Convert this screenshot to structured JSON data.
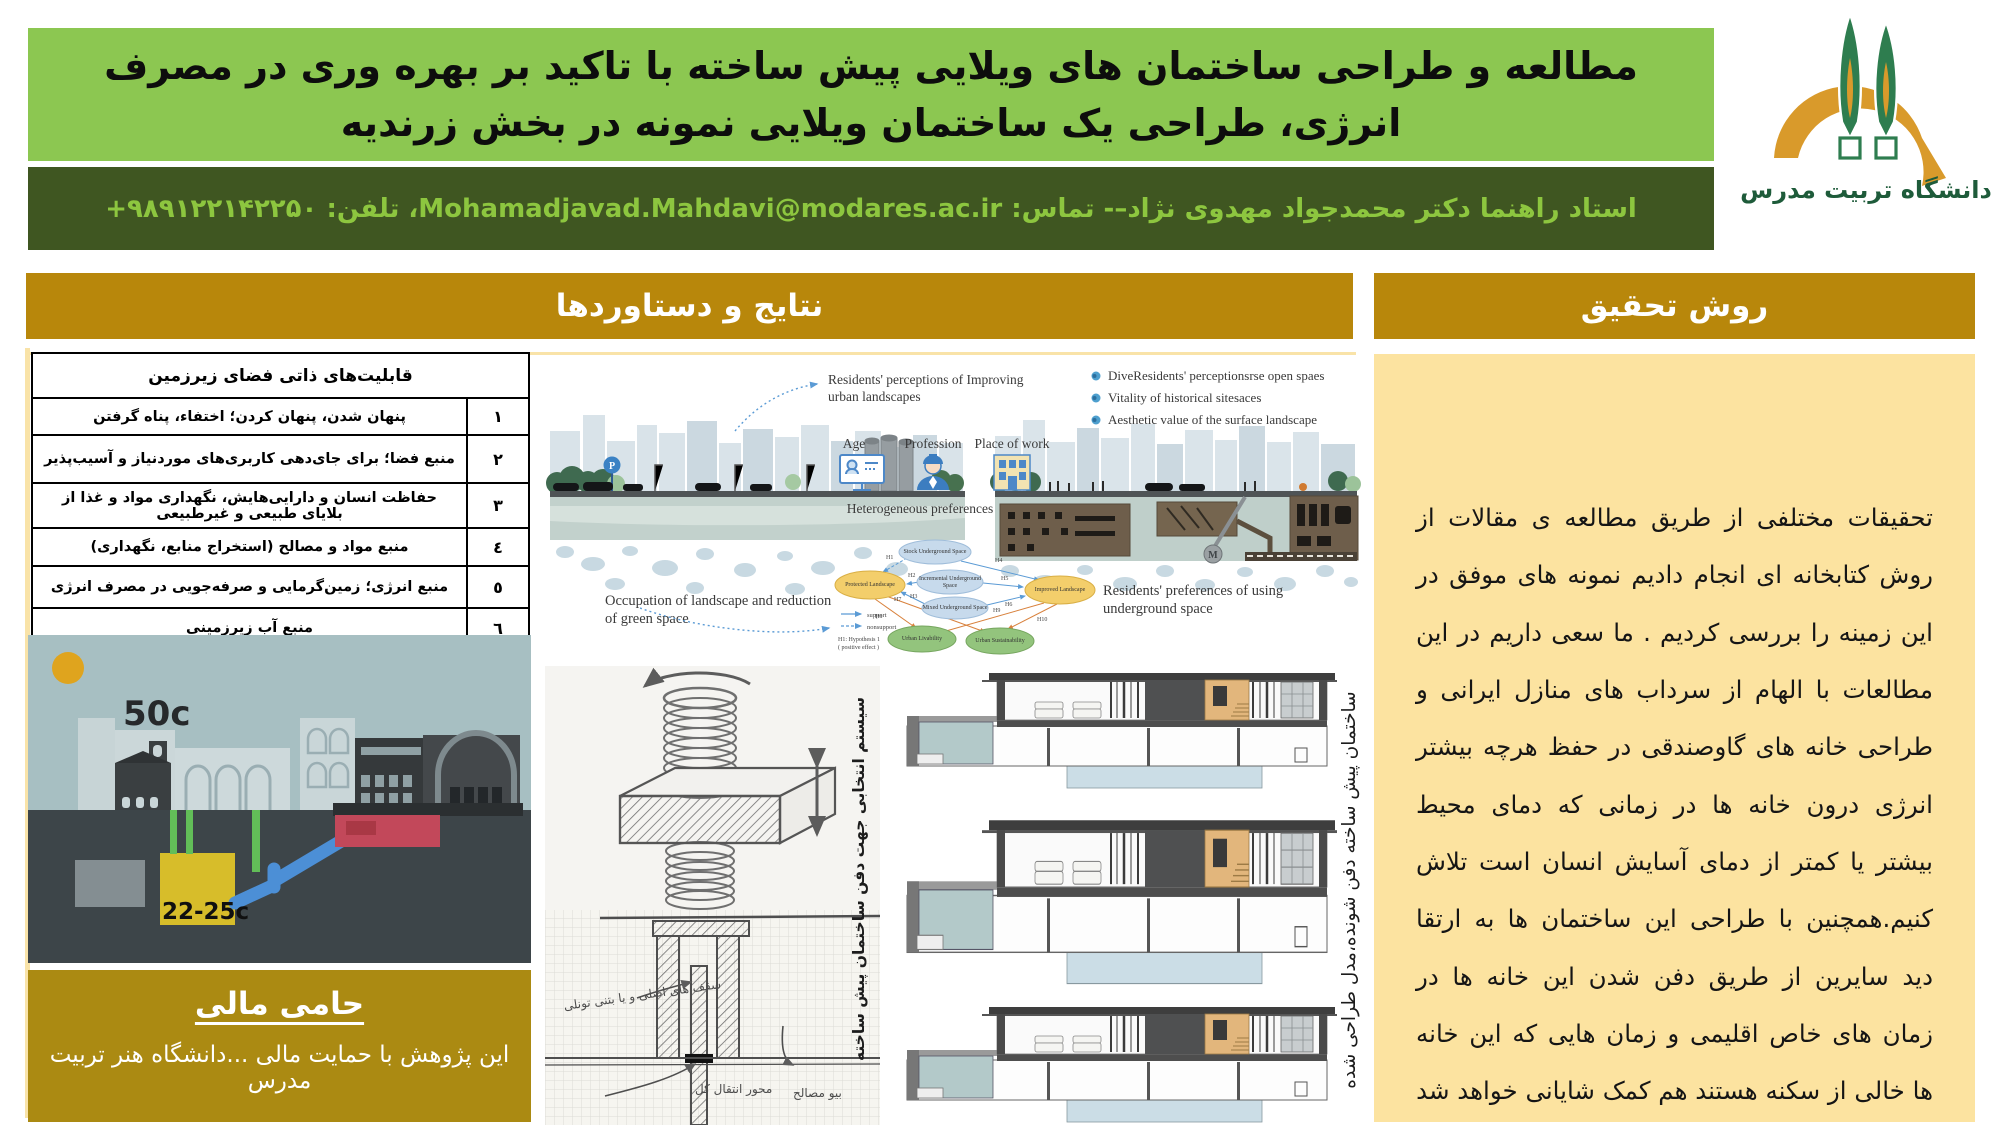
{
  "header": {
    "title": "مطالعه و طراحی ساختمان های ویلایی پیش ساخته با تاکید بر بهره وری در مصرف انرژی، طراحی یک ساختمان ویلایی نمونه در بخش زرندیه",
    "supervisor": "استاد راهنما دکتر محمدجواد مهدوی نژاد–- تماس: Mohamadjavad.Mahdavi@modares.ac.ir، تلفن: ۹۸۹۱۲۲۱۴۲۲۵۰+",
    "logo_caption": "دانشگاه تربیت مدرس"
  },
  "results": {
    "title": "نتایج و دستاوردها",
    "table": {
      "header": "قابلیت‌های ذاتی فضای زیرزمین",
      "rows": [
        {
          "num": "١",
          "text": "پنهان شدن، پنهان کردن؛ اختفاء، پناه گرفتن"
        },
        {
          "num": "٢",
          "text": "منبع فضا؛ برای جای‌دهی کاربری‌های موردنیاز و آسیب‌پذیر"
        },
        {
          "num": "٣",
          "text": "حفاظت انسان و دارایی‌هایش، نگهداری مواد و غذا از بلایای طبیعی و غیرطبیعی"
        },
        {
          "num": "٤",
          "text": "منبع مواد و مصالح (استخراج منابع، نگهداری)"
        },
        {
          "num": "٥",
          "text": "منبع انرژی؛ زمین‌گرمایی و صرفه‌جویی در مصرف انرژی"
        },
        {
          "num": "٦",
          "text": "منبع آب زیرزمینی"
        }
      ]
    },
    "underground_diagram": {
      "surface_temp": "50c",
      "cellar_temp": "22-25c"
    },
    "figure": {
      "perception_caption": "Residents'  perceptions of Improving urban landscapes",
      "bullets": [
        "DiveResidents' perceptionsrse open spaes",
        "Vitality of historical sitesaces",
        "Aesthetic  value of the surface landscape"
      ],
      "icon_labels": [
        "Age",
        "Profession",
        "Place of work"
      ],
      "heterogeneous_label": "Heterogeneous preferences",
      "occupation_caption": "Occupation of landscape and reduction of green space",
      "preferences_caption": "Residents'  preferences of using underground space",
      "parking_sign": "P",
      "metro_sign": "M",
      "flow": {
        "nodes": {
          "stock": "Stock Underground Space",
          "incremental": "Incremental Underground Space",
          "mixed": "Mixed Underground Space",
          "protected": "Protected Landscape",
          "improved": "Improved Landscape",
          "livability": "Urban Livability",
          "sustainability": "Urban Sustainability"
        },
        "h_labels": [
          "H1",
          "H2",
          "H3",
          "H4",
          "H5",
          "H6",
          "H7",
          "H8",
          "H9",
          "H10"
        ],
        "legend": {
          "support": "support",
          "nonsupport": "nonsupport",
          "note1": "H1: Hypothesis 1",
          "note2": "( positive effect )"
        }
      }
    },
    "sketch": {
      "vertical_label": "سیستم انتخابی جهت دفن ساختمان پیش ساخته",
      "annotations": [
        "سقف های اصلی و یا بتنی تونلی",
        "محور انتقال کل",
        "بیو مصالح"
      ]
    },
    "model": {
      "vertical_label": "ساختمان پیش ساخته دفن شونده،مدل طراحی شده"
    }
  },
  "method": {
    "title": "روش تحقیق",
    "body": "تحقیقات مختلفی از طریق مطالعه ی مقالات از روش کتابخانه ای انجام دادیم نمونه های موفق  در این زمینه را بررسی کردیم . ما سعی داریم در این مطالعات با الهام از سرداب های منازل ایرانی و طراحی خانه های گاوصندقی در حفظ هرچه بیشتر انرژی درون خانه ها در زمانی که دمای محیط بیشتر یا کمتر از دمای آسایش انسان است تلاش کنیم.همچنین با طراحی این ساختمان ها به ارتقا دید سایرین از طریق دفن شدن این خانه ها در زمان های خاص اقلیمی و زمان هایی که این خانه ها خالی از سکنه هستند هم کمک شایانی خواهد شد"
  },
  "sponsor": {
    "title": "حامی مالی",
    "body": "این پژوهش با حمایت مالی ...دانشگاه هنر تربیت مدرس"
  },
  "colors": {
    "light_green": "#8CC751",
    "dark_green": "#3F5621",
    "accent_green_text": "#8DC63F",
    "gold_header": "#B8870B",
    "cream_panel": "#FCE3A0",
    "sponsor_gold": "#AB8A12"
  }
}
